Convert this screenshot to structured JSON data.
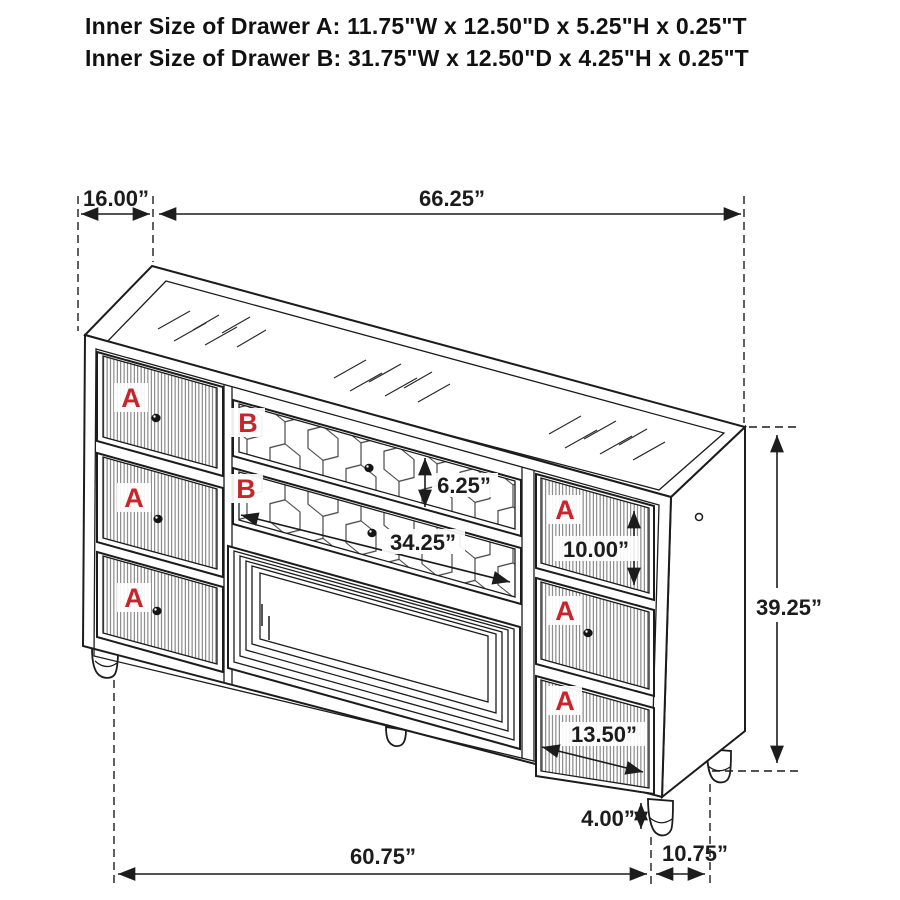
{
  "header": {
    "drawer_a_size": "Inner Size of Drawer A: 11.75\"W x 12.50\"D x 5.25\"H x 0.25\"T",
    "drawer_b_size": "Inner Size of Drawer B: 31.75\"W x 12.50\"D x 4.25\"H x 0.25\"T"
  },
  "drawer_labels": {
    "a": "A",
    "b": "B"
  },
  "dimensions": {
    "top_depth": "16.00”",
    "top_width": "66.25”",
    "overall_height": "39.25”",
    "drawer_b_face_height": "6.25”",
    "drawer_b_face_width": "34.25”",
    "drawer_a_right_face_height": "10.00”",
    "drawer_a_right_face_width": "13.50”",
    "leg_height": "4.00”",
    "base_width": "60.75”",
    "base_side_depth": "10.75”"
  },
  "colors": {
    "line": "#1c1c1c",
    "label_red": "#c8242c",
    "background": "#ffffff"
  }
}
